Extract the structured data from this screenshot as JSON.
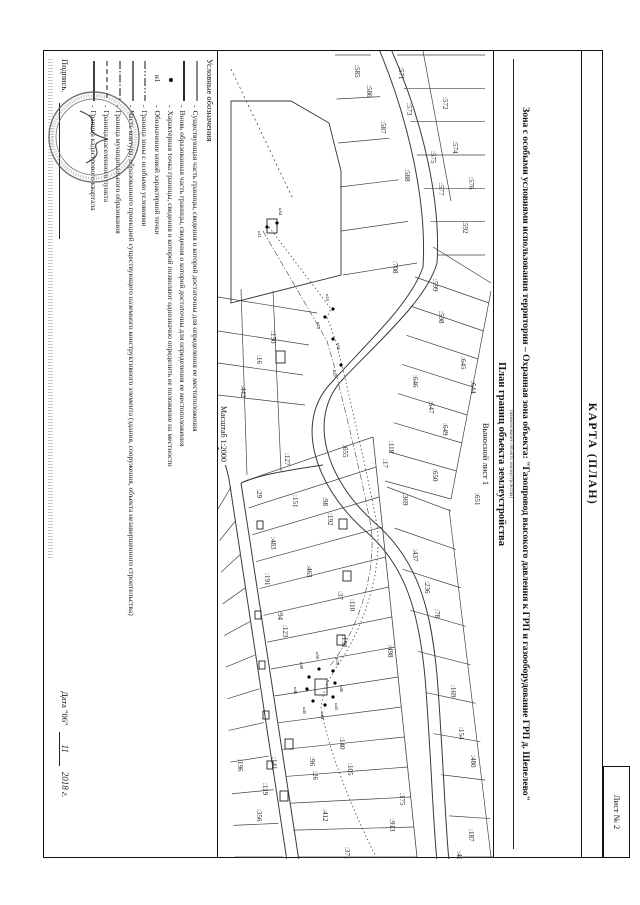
{
  "page": {
    "sheet_label": "Лист № 2"
  },
  "header": {
    "form_title": "КАРТА (ПЛАН)",
    "object_title": "Зона с особыми условиями использования территории – Охранная зона объекта: \"Газопровод высокого давления к ГРП и газооборудование ГРП д. Шепелево\"",
    "object_title_caption": "(наименование объекта землеустройства)",
    "plan_title": "План границ объекта землеустройства",
    "inset_label": "Выносной лист 1",
    "scale_label": "Масштаб 1:2000"
  },
  "legend": {
    "title": "Условные обозначения",
    "items": [
      {
        "symbol": "solid",
        "label": "Существующая часть границы, сведения о которой достаточны для определения ее местоположения"
      },
      {
        "symbol": "bold",
        "label": "Вновь образованная часть границы, сведения о которой достаточны для определения ее местоположения"
      },
      {
        "symbol": "dot",
        "label": "Характерная точка границы, сведения о которой позволяют однозначно определить ее положение на местности"
      },
      {
        "symbol": "n1",
        "label": "Обозначение новой характерной точки"
      },
      {
        "symbol": "dashdotdot",
        "label": "Граница зоны с особыми условиями"
      },
      {
        "symbol": "solid2",
        "label": "Часть контура, образованного проекцией существующего наземного конструктивного элемента (здания, сооружения, объекта незавершенного строительства)"
      },
      {
        "symbol": "dashdot",
        "label": "Граница муниципального образования"
      },
      {
        "symbol": "dashed",
        "label": "Граница населенного пункта"
      },
      {
        "symbol": "solid3",
        "label": "Граница кадастрового квартала"
      }
    ]
  },
  "footer": {
    "signature_label": "Подпись.",
    "date_prefix": "Дата \"06\"",
    "date_month": "11",
    "date_year": "2018 г."
  },
  "map": {
    "roads": [
      "M 212,56 C 248,66 288,112 328,150 C 366,186 428,168 472,118 C 510,74 560,62 624,56 C 700,50 770,48 810,44",
      "M 216,70 C 252,82 292,126 332,162 C 370,198 432,180 478,130 C 514,86 564,74 626,68 C 702,62 772,60 810,56",
      "M -2,102 C 70,70 150,52 212,56",
      "M -2,114 C 70,84 152,66 216,70",
      "M 414,170 C 420,210 424,234 432,252",
      "M 432,252 L 810,194",
      "M 428,264 L 810,206",
      "M 428,264 C 410,268 400,272 392,278"
    ],
    "strips": [
      {
        "a": [
          386,
          120,
          806,
          76
        ],
        "b": [
          430,
          248,
          806,
          196
        ],
        "n": 14
      },
      {
        "a": [
          436,
          262,
          806,
          210
        ],
        "b": [
          458,
          275,
          806,
          258
        ],
        "n": 11
      },
      {
        "a": [
          4,
          96,
          204,
          56
        ],
        "b": [
          4,
          8,
          204,
          8
        ],
        "n": 6
      },
      {
        "a": [
          4,
          122,
          212,
          76
        ],
        "b": [
          4,
          158,
          224,
          150
        ],
        "n": 5
      },
      {
        "a": [
          226,
          78,
          430,
          108
        ],
        "b": [
          252,
          4,
          448,
          42
        ],
        "n": 7
      },
      {
        "a": [
          436,
          106,
          806,
          36
        ],
        "b": [
          460,
          42,
          806,
          -2
        ],
        "n": 9
      }
    ],
    "aux_lines": [
      {
        "d": "M 386,120 L 806,76",
        "w": 0.8,
        "dash": ""
      },
      {
        "d": "M 240,2 L 448,42",
        "w": 0.7,
        "dash": ""
      },
      {
        "d": "M 458,44 L 806,2",
        "w": 0.7,
        "dash": ""
      },
      {
        "d": "M 0,70 L 150,42",
        "w": 0.7,
        "dash": ""
      },
      {
        "d": "M 196,60 L 232,2",
        "w": 0.7,
        "dash": ""
      },
      {
        "d": "M 262,176 L 246,275",
        "w": 0.7,
        "dash": ""
      },
      {
        "d": "M 294,184 L 280,275",
        "w": 0.7,
        "dash": ""
      },
      {
        "d": "M 324,190 L 312,275",
        "w": 0.7,
        "dash": ""
      },
      {
        "d": "M 354,188 L 344,275",
        "w": 0.7,
        "dash": ""
      },
      {
        "d": "M 240,220 L 420,212",
        "w": 0.7,
        "dash": ""
      },
      {
        "d": "M 238,252 L 424,246",
        "w": 0.7,
        "dash": ""
      },
      {
        "d": "M 18,262 L 148,200",
        "w": 0.8,
        "dash": "2 3"
      },
      {
        "d": "M 176,224 L 258,162 L 266,166 L 288,158 L 314,151 C 380,136 430,124 474,116 C 520,110 580,130 618,158 L 636,168 L 656,172 C 700,165 760,140 808,116",
        "w": 0.8,
        "dash": "1.5 2.5"
      },
      {
        "d": "M 180,230 L 290,166 L 318,158 C 384,142 432,130 476,122 C 522,116 582,136 616,164",
        "w": 0.6,
        "dash": "6 2 1.5 2"
      }
    ],
    "polygons": [
      "252,262 224,152 120,152 72,164 50,202 50,262"
    ],
    "buildings": [
      [
        168,
        216,
        14,
        10
      ],
      [
        300,
        208,
        12,
        9
      ],
      [
        468,
        146,
        10,
        8
      ],
      [
        520,
        142,
        10,
        8
      ],
      [
        584,
        148,
        10,
        8
      ],
      [
        628,
        166,
        16,
        12
      ],
      [
        688,
        200,
        10,
        8
      ],
      [
        740,
        205,
        10,
        8
      ],
      [
        470,
        230,
        8,
        6
      ],
      [
        560,
        232,
        8,
        6
      ],
      [
        610,
        228,
        8,
        6
      ],
      [
        660,
        224,
        8,
        6
      ],
      [
        710,
        220,
        8,
        6
      ]
    ],
    "labels": [
      [
        ":585",
        14,
        138
      ],
      [
        ":586",
        34,
        126
      ],
      [
        ":587",
        70,
        112
      ],
      [
        ":588",
        118,
        88
      ],
      [
        ":592",
        170,
        30
      ],
      [
        ":571",
        16,
        94
      ],
      [
        ":572",
        46,
        50
      ],
      [
        ":573",
        52,
        86
      ],
      [
        ":574",
        90,
        40
      ],
      [
        ":575",
        100,
        62
      ],
      [
        ":576",
        126,
        24
      ],
      [
        ":577",
        132,
        54
      ],
      [
        ":708",
        210,
        100
      ],
      [
        ":599",
        228,
        60
      ],
      [
        ":598",
        260,
        54
      ],
      [
        ":645",
        306,
        32
      ],
      [
        ":644",
        330,
        22
      ],
      [
        ":646",
        324,
        80
      ],
      [
        ":647",
        350,
        64
      ],
      [
        ":649",
        372,
        50
      ],
      [
        ":650",
        418,
        60
      ],
      [
        ":651",
        442,
        18
      ],
      [
        ":118",
        390,
        104
      ],
      [
        ":17",
        408,
        110
      ],
      [
        ":369",
        442,
        90
      ],
      [
        ":437",
        498,
        80
      ],
      [
        ":236",
        530,
        68
      ],
      [
        ":78",
        558,
        58
      ],
      [
        ":169",
        634,
        42
      ],
      [
        ":154",
        676,
        34
      ],
      [
        ":480",
        704,
        22
      ],
      [
        ":187",
        778,
        24
      ],
      [
        ":424",
        800,
        36
      ],
      [
        ":150",
        280,
        222
      ],
      [
        ":16",
        304,
        236
      ],
      [
        ":442",
        334,
        252
      ],
      [
        ":655",
        394,
        150
      ],
      [
        ":127",
        402,
        208
      ],
      [
        ":29",
        438,
        236
      ],
      [
        ":151",
        444,
        200
      ],
      [
        ":98",
        446,
        170
      ],
      [
        ":192",
        462,
        165
      ],
      [
        ":483",
        486,
        222
      ],
      [
        ":463",
        514,
        186
      ],
      [
        ":191",
        522,
        228
      ],
      [
        ":94",
        560,
        215
      ],
      [
        ":123",
        574,
        210
      ],
      [
        ":37",
        540,
        155
      ],
      [
        ":110",
        548,
        143
      ],
      [
        ":152",
        584,
        151
      ],
      [
        ":498",
        594,
        105
      ],
      [
        ":140",
        686,
        153
      ],
      [
        ":105",
        712,
        145
      ],
      [
        ":96",
        706,
        183
      ],
      [
        ":26",
        720,
        180
      ],
      [
        ":141",
        706,
        221
      ],
      [
        ":196",
        708,
        255
      ],
      [
        ":119",
        732,
        230
      ],
      [
        ":356",
        758,
        236
      ],
      [
        ":412",
        758,
        170
      ],
      [
        ":175",
        742,
        93
      ],
      [
        ":913",
        768,
        103
      ],
      [
        ":371",
        796,
        148
      ]
    ],
    "points": [
      [
        172,
        216,
        "н54",
        -15,
        -2
      ],
      [
        176,
        226,
        "н11",
        4,
        9
      ],
      [
        258,
        160,
        "н10",
        -15,
        7
      ],
      [
        266,
        168,
        "н55",
        5,
        8
      ],
      [
        288,
        160,
        "н56",
        4,
        -4
      ],
      [
        314,
        152,
        "н57",
        5,
        8
      ],
      [
        620,
        160,
        "н39",
        -13,
        -3
      ],
      [
        632,
        158,
        "н40",
        2,
        -5
      ],
      [
        646,
        160,
        "н43",
        6,
        -2
      ],
      [
        654,
        168,
        "н44",
        7,
        4
      ],
      [
        650,
        180,
        "н45",
        6,
        10
      ],
      [
        638,
        186,
        "н46",
        -2,
        13
      ],
      [
        626,
        184,
        "н49",
        -15,
        9
      ],
      [
        618,
        174,
        "н50",
        -17,
        3
      ]
    ]
  }
}
